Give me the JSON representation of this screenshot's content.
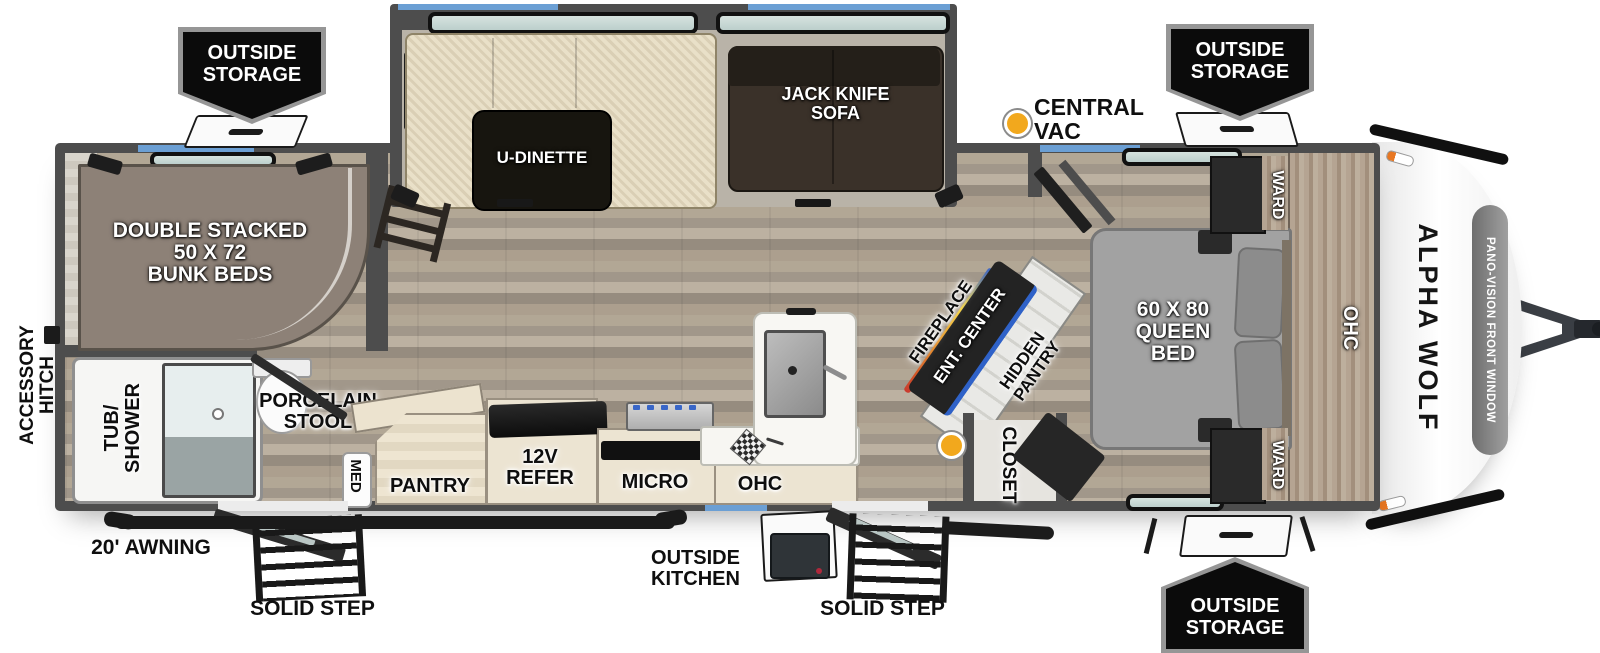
{
  "floorplan": {
    "brand": "ALPHA WOLF",
    "front_window": "PANO-VISION FRONT WINDOW",
    "badge_outside_storage": "OUTSIDE\nSTORAGE",
    "callouts": {
      "central_vac": "CENTRAL VAC",
      "accessory_hitch": "ACCESSORY\nHITCH",
      "awning": "20' AWNING",
      "solid_step": "SOLID STEP",
      "outside_kitchen": "OUTSIDE\nKITCHEN"
    },
    "labels": {
      "bunk_beds": "DOUBLE STACKED\n50 X 72\nBUNK BEDS",
      "u_dinette": "U-DINETTE",
      "jack_knife_sofa": "JACK KNIFE\nSOFA",
      "queen_bed": "60 X 80\nQUEEN\nBED",
      "ward": "WARD",
      "ohc": "OHC",
      "hidden_pantry": "HIDDEN\nPANTRY",
      "ent_center": "ENT. CENTER",
      "fireplace": "FIREPLACE",
      "closet": "CLOSET",
      "micro": "MICRO",
      "refer": "12V\nREFER",
      "pantry": "PANTRY",
      "med": "MED",
      "porcelain_stool": "PORCELAIN\nSTOOL",
      "tub_shower": "TUB/\nSHOWER"
    },
    "colors": {
      "wall": "#4d4d4d",
      "floor": "#ab9f90",
      "accent_blue": "#6b9fd4",
      "vac_dot": "#f2a81d",
      "badge_bg": "#0b0b0b"
    }
  }
}
